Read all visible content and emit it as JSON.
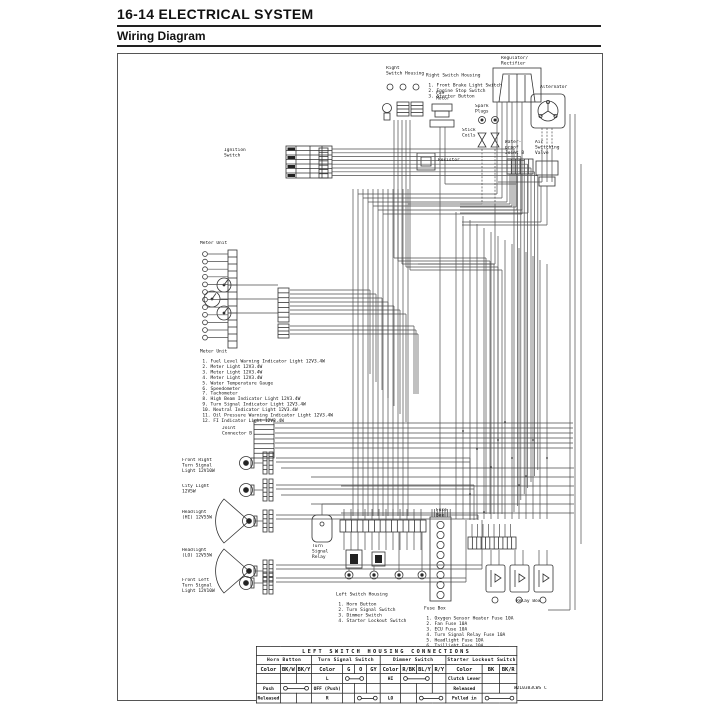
{
  "header": {
    "title": "16-14 ELECTRICAL SYSTEM",
    "subtitle": "Wiring Diagram"
  },
  "diagram": {
    "part_number": "W2L0383CWS C",
    "labels": {
      "right_switch_housing": "Right\nSwitch Housing",
      "regulator_rectifier": "Regulator/\nRectifier",
      "alternator": "Alternator",
      "fan_motor": "Fan\nMotor",
      "spark_plugs": "Spark\nPlugs",
      "stick_coils": "Stick\nCoils",
      "resistor": "Resistor",
      "waterproof_joint_b": "Water-\nproof\nJoint B",
      "air_switching_valve": "Air\nSwitching\nValve",
      "ignition_switch": "Ignition\nSwitch",
      "meter_unit_top": "Meter Unit",
      "joint_connector_b": "Joint\nConnector B",
      "front_right_turn_signal": "Front Right\nTurn Signal\nLight 12V10W",
      "city_light": "City Light\n12V5W",
      "headlight_hi": "Headlight\n(HI) 12V55W",
      "headlight_lo": "Headlight\n(LO) 12V55W",
      "front_left_turn_signal": "Front Left\nTurn Signal\nLight 12V10W",
      "turn_signal_relay": "Turn\nSignal\nRelay",
      "fuse_box": "Fuse\nBox",
      "relay_box": "Relay Box"
    },
    "notes": {
      "right_switch_housing": {
        "title": "Right Switch Housing",
        "items": [
          "1. Front Brake Light Switch",
          "2. Engine Stop Switch",
          "3. Starter Button"
        ]
      },
      "meter_unit": {
        "title": "Meter Unit",
        "items": [
          "1. Fuel Level Warning Indicator Light 12V3.4W",
          "2. Meter Light 12V3.4W",
          "3. Meter Light 12V3.4W",
          "4. Meter Light 12V3.4W",
          "5. Water Temperature Gauge",
          "6. Speedometer",
          "7. Tachometer",
          "8. High Beam Indicator Light 12V3.4W",
          "9. Turn Signal Indicator Light 12V3.4W",
          "10. Neutral Indicator Light 12V3.4W",
          "11. Oil Pressure Warning Indicator Light 12V3.4W",
          "12. FI Indicator Light 12V3.4W"
        ]
      },
      "left_switch_housing": {
        "title": "Left Switch Housing",
        "items": [
          "1. Horn Button",
          "2. Turn Signal Switch",
          "3. Dimmer Switch",
          "4. Starter Lockout Switch"
        ]
      },
      "fuse_box": {
        "title": "Fuse Box",
        "items": [
          "1. Oxygen Sensor Heater Fuse 10A",
          "2. Fan Fuse 10A",
          "3. ECU Fuse 10A",
          "4. Turn Signal Relay Fuse 10A",
          "5. Headlight Fuse 10A",
          "6. Taillight Fuse 10A",
          "7. Ignition Fuse 10A",
          "8. Horn Fuse 10A"
        ]
      }
    }
  },
  "connections_table": {
    "title": "LEFT SWITCH HOUSING CONNECTIONS",
    "color_header": "Color",
    "sections": [
      {
        "name": "Horn Button",
        "label_width": 30,
        "colors": [
          "BK/W",
          "BK/Y"
        ],
        "rows": [
          {
            "label": ""
          },
          {
            "label": "Push",
            "bar": [
              0,
              1
            ]
          },
          {
            "label": "Released"
          }
        ]
      },
      {
        "name": "Turn Signal Switch",
        "label_width": 42,
        "colors": [
          "G",
          "O",
          "GY"
        ],
        "rows": [
          {
            "label": "L",
            "bar": [
              0,
              1
            ]
          },
          {
            "label": "OFF (Push)"
          },
          {
            "label": "R",
            "bar": [
              1,
              2
            ]
          }
        ]
      },
      {
        "name": "Dimmer Switch",
        "label_width": 32,
        "colors": [
          "R/BK",
          "BL/Y",
          "R/Y"
        ],
        "rows": [
          {
            "label": "HI",
            "bar": [
              0,
              1
            ]
          },
          {
            "label": ""
          },
          {
            "label": "LO",
            "bar": [
              1,
              2
            ]
          }
        ]
      },
      {
        "name": "Starter Lockout Switch",
        "label_width": 44,
        "colors": [
          "BK",
          "BK/R"
        ],
        "rows": [
          {
            "label": "Clutch Lever"
          },
          {
            "label": "Released"
          },
          {
            "label": "Pulled in",
            "bar": [
              0,
              1
            ]
          }
        ]
      }
    ]
  }
}
